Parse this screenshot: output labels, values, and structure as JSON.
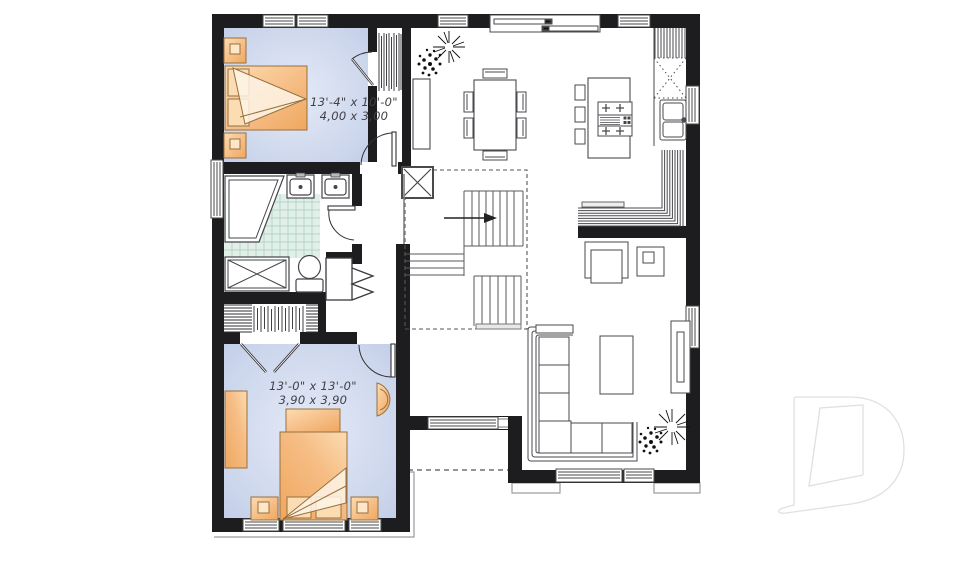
{
  "plan": {
    "rooms": {
      "bedroom1": {
        "dim_imperial": "13'-4\" x 10'-0\"",
        "dim_metric": "4,00 x 3,00"
      },
      "bedroom2": {
        "dim_imperial": "13'-0\" x 13'-0\"",
        "dim_metric": "3,90 x 3,90"
      }
    },
    "colors": {
      "wall": "#1d1d1f",
      "bedroom_floor_edge": "#bfcbe7",
      "bedroom_floor_center": "#e4eaf7",
      "furniture_orange_dark": "#efa75f",
      "furniture_orange_light": "#fcdcb2",
      "tile_fill": "#e2efe9",
      "tile_line": "#b2d6c8",
      "line": "#3c3c40",
      "watermark_outline": "#e0e0e0"
    }
  }
}
